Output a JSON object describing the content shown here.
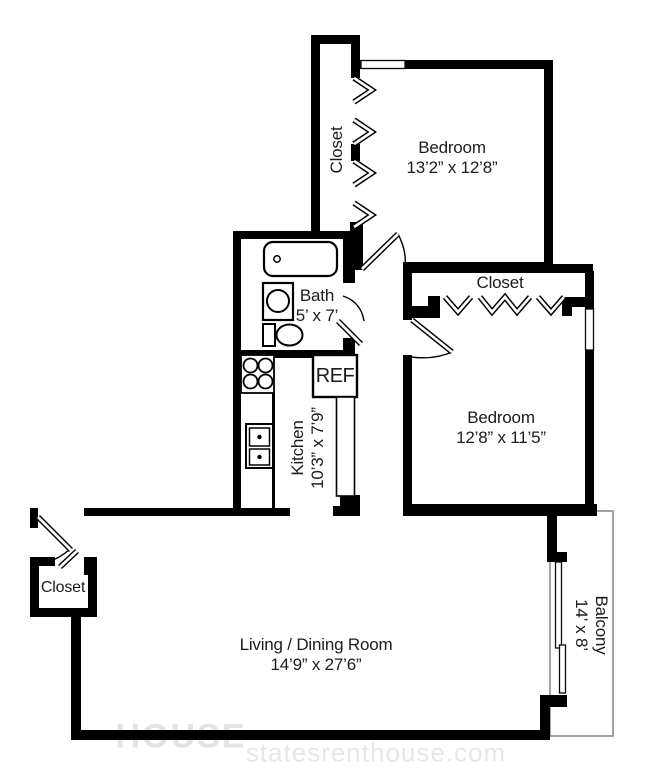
{
  "rooms": {
    "closet_top": {
      "name": "Closet"
    },
    "bedroom_1": {
      "name": "Bedroom",
      "dims": "13’2” x 12’8”"
    },
    "closet_mid": {
      "name": "Closet"
    },
    "bath": {
      "name": "Bath",
      "dims": "5’ x 7’"
    },
    "kitchen": {
      "name": "Kitchen",
      "dims": "10’3” x 7’9”"
    },
    "bedroom_2": {
      "name": "Bedroom",
      "dims": "12’8” x 11’5”"
    },
    "closet_entry": {
      "name": "Closet"
    },
    "living_dining": {
      "name": "Living / Dining Room",
      "dims": "14’9” x 27’6”"
    },
    "balcony": {
      "name": "Balcony",
      "dims": "14’ x 8’"
    }
  },
  "appliances": {
    "refrigerator": "REF"
  },
  "watermark": {
    "logo": "HOUSE",
    "site": "statesrenthouse.com"
  },
  "colors": {
    "wall": "#000000",
    "text": "#1c1c1c",
    "balcony_outline": "#8a8a8a",
    "watermark": "#e5e5e5"
  }
}
